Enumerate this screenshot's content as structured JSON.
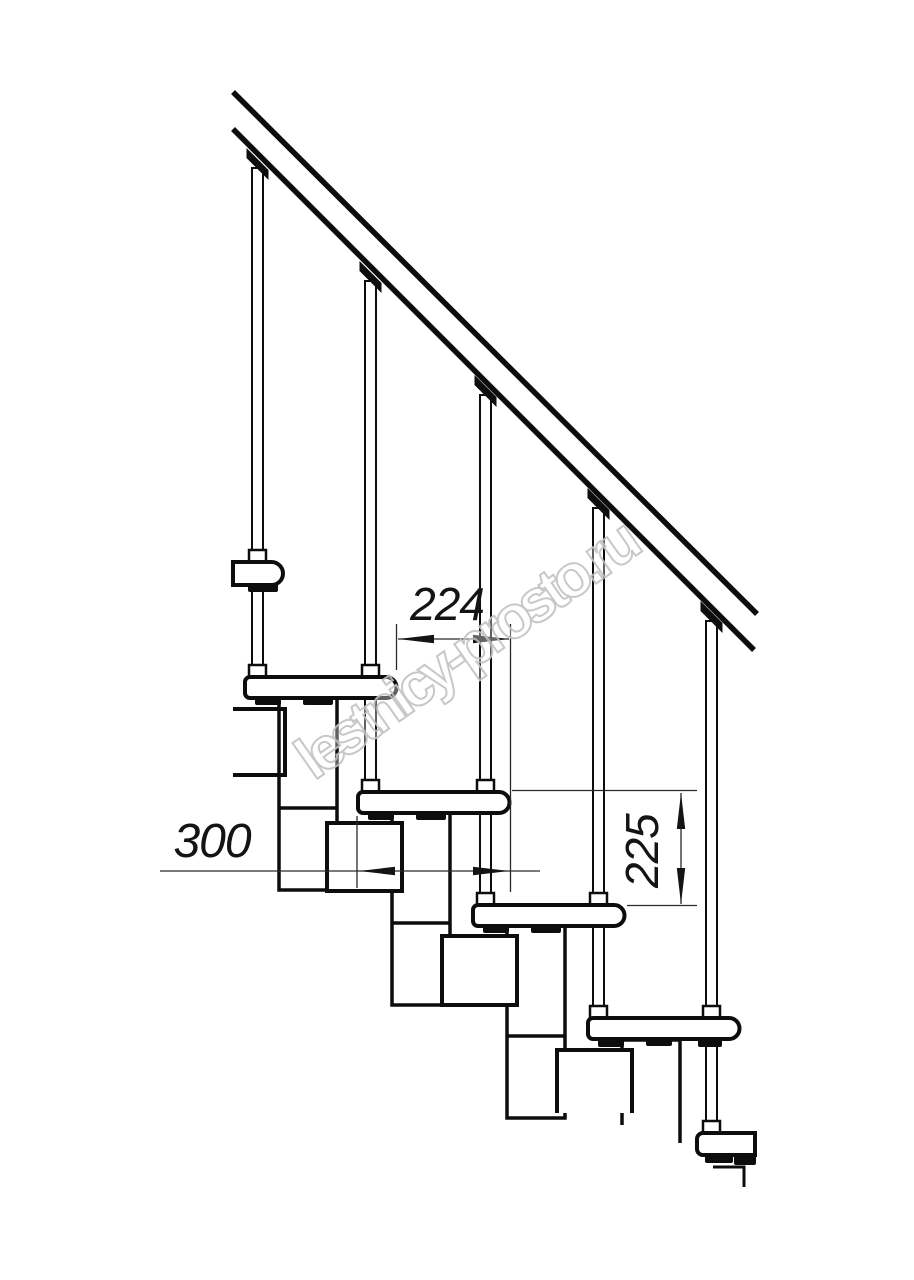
{
  "page": {
    "kind": "technical line drawing",
    "subject": "modular staircase side-view fragment with handrail, balusters, treads and support modules",
    "background_color": "#ffffff",
    "line_color": "#0d0d0d"
  },
  "watermark": {
    "text": "lestnicy-prosto.ru",
    "stroke_color": "#c3c3c3"
  },
  "dimensions": {
    "going": {
      "value": "224"
    },
    "tread_length": {
      "value": "300"
    },
    "rise": {
      "value": "225"
    }
  }
}
